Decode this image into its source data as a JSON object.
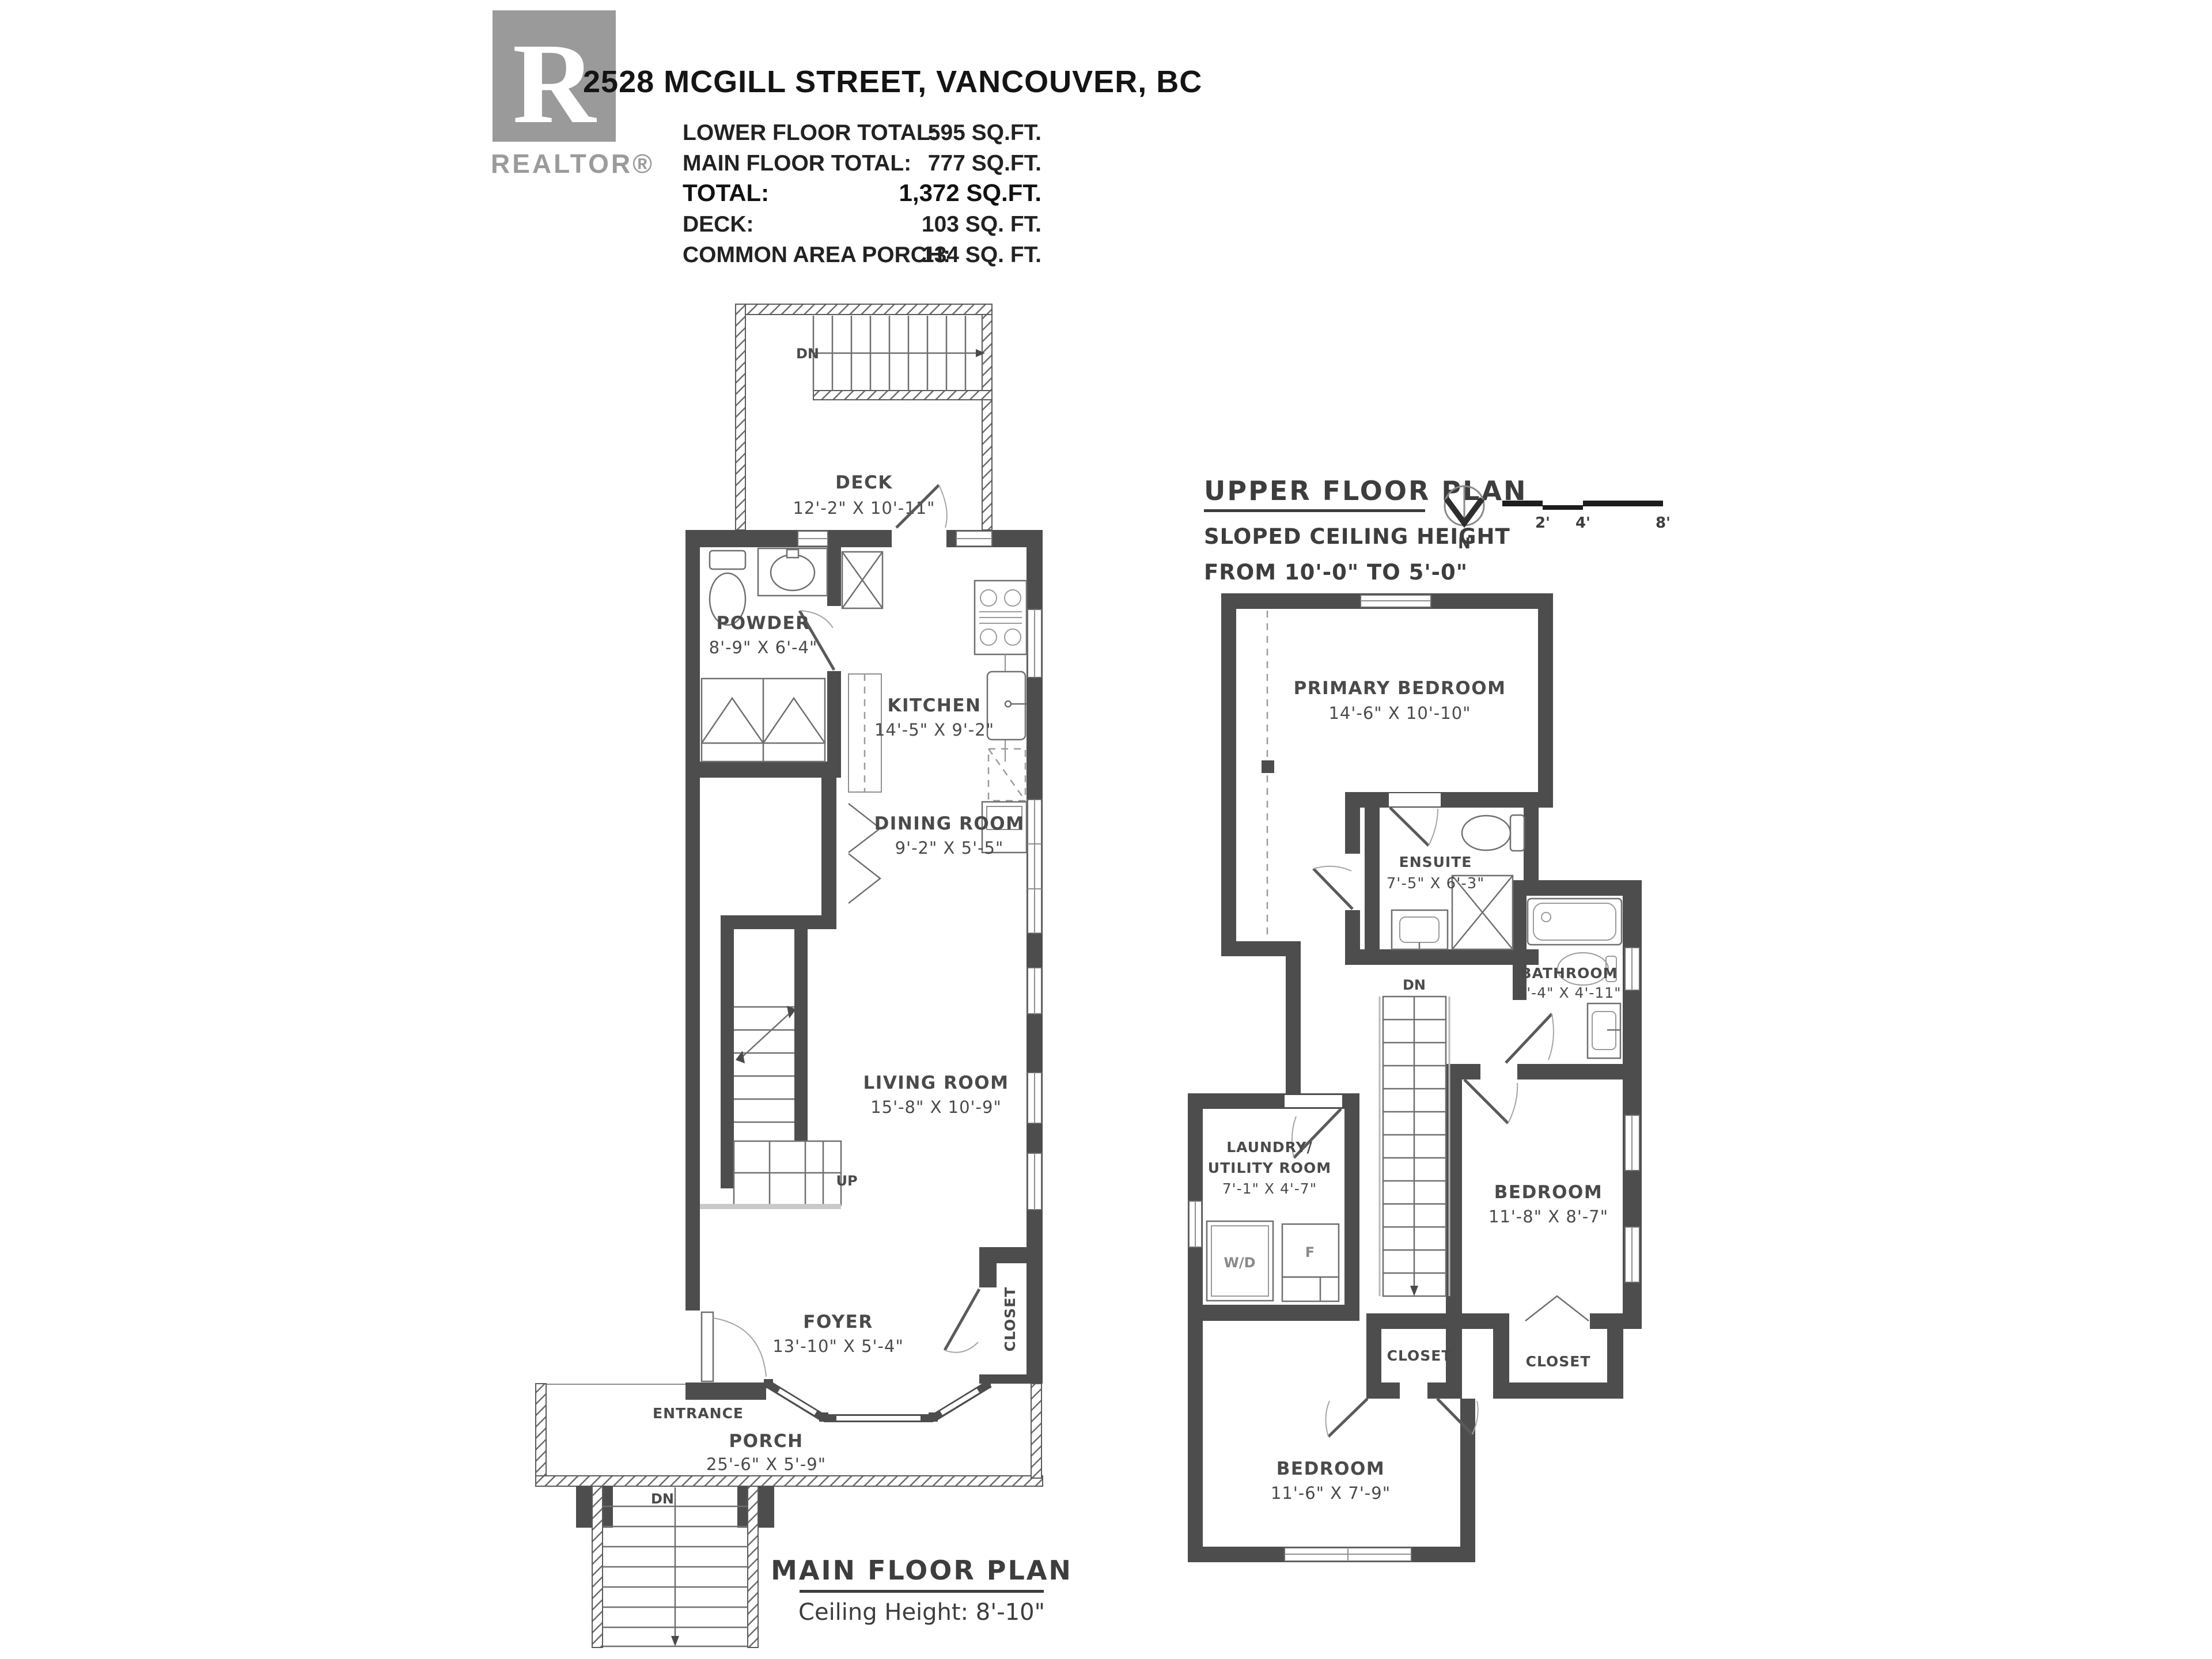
{
  "header": {
    "logo_letter": "R",
    "logo_brand": "REALTOR®",
    "title": "2528 MCGILL STREET, VANCOUVER, BC",
    "stats": [
      {
        "label": "LOWER FLOOR TOTAL:",
        "value": "595 SQ.FT."
      },
      {
        "label": "MAIN FLOOR TOTAL:",
        "value": "777 SQ.FT."
      },
      {
        "label": "TOTAL:",
        "value": "1,372 SQ.FT."
      },
      {
        "label": "DECK:",
        "value": "103 SQ. FT."
      },
      {
        "label": "COMMON AREA PORCH:",
        "value": "134 SQ. FT."
      }
    ]
  },
  "main_floor": {
    "title": "MAIN FLOOR PLAN",
    "subtitle": "Ceiling Height: 8'-10\"",
    "rooms": {
      "deck": {
        "name": "DECK",
        "dims": "12'-2\" X 10'-11\""
      },
      "powder": {
        "name": "POWDER",
        "dims": "8'-9\" X 6'-4\""
      },
      "kitchen": {
        "name": "KITCHEN",
        "dims": "14'-5\" X 9'-2\""
      },
      "dining": {
        "name": "DINING ROOM",
        "dims": "9'-2\" X 5'-5\""
      },
      "living": {
        "name": "LIVING ROOM",
        "dims": "15'-8\" X 10'-9\""
      },
      "foyer": {
        "name": "FOYER",
        "dims": "13'-10\" X 5'-4\""
      },
      "porch": {
        "name": "PORCH",
        "dims": "25'-6\" X 5'-9\""
      },
      "closet": "CLOSET",
      "entrance": "ENTRANCE"
    },
    "labels": {
      "up": "UP",
      "dn": "DN"
    }
  },
  "upper_floor": {
    "title": "UPPER FLOOR PLAN",
    "subtitle_line1": "SLOPED CEILING HEIGHT",
    "subtitle_line2": "FROM 10'-0\" TO 5'-0\"",
    "compass_label": "N",
    "scale_labels": [
      "2'",
      "4'",
      "8'"
    ],
    "rooms": {
      "primary": {
        "name": "PRIMARY BEDROOM",
        "dims": "14'-6\" X 10'-10\""
      },
      "ensuite": {
        "name": "ENSUITE",
        "dims": "7'-5\" X 6'-3\""
      },
      "bathroom": {
        "name": "BATHROOM",
        "dims": "8'-4\" X 4'-11\""
      },
      "bedroom_right": {
        "name": "BEDROOM",
        "dims": "11'-8\" X 8'-7\""
      },
      "bedroom_bottom": {
        "name": "BEDROOM",
        "dims": "11'-6\" X 7'-9\""
      },
      "laundry": {
        "name_line1": "LAUNDRY/",
        "name_line2": "UTILITY ROOM",
        "dims": "7'-1\" X 4'-7\""
      },
      "closet_middle": "CLOSET",
      "closet_right": "CLOSET"
    },
    "appliances": {
      "wd": "W/D",
      "f": "F"
    },
    "labels": {
      "dn": "DN"
    }
  },
  "colors": {
    "wall": "#4d4d4d",
    "logo_gray": "#9a9a9a"
  }
}
